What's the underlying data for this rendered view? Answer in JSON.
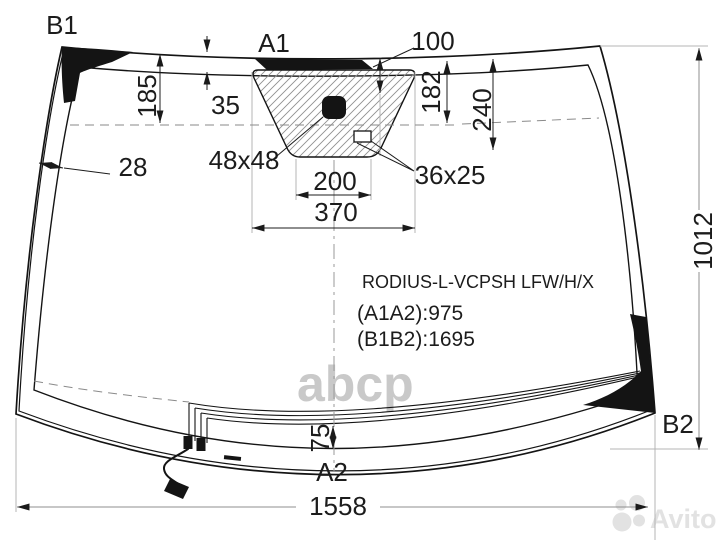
{
  "diagram": {
    "part_code": "RODIUS-L-VCPSH LFW/H/X",
    "diagonals": {
      "a1a2": "(A1A2):975",
      "b1b2": "(B1B2):1695"
    },
    "markers": {
      "b1": "B1",
      "a1": "A1",
      "a2": "A2",
      "b2": "B2"
    },
    "dims": {
      "d185": "185",
      "d35": "35",
      "d100": "100",
      "d182": "182",
      "d240": "240",
      "d28": "28",
      "d48": "48x48",
      "d36": "36x25",
      "d200": "200",
      "d370": "370",
      "d1012": "1012",
      "d75": "75",
      "d1558": "1558"
    }
  },
  "watermarks": {
    "center": "abcp",
    "brand": "Avito"
  },
  "colors": {
    "line": "#141414",
    "dimension_text": "#1c1c1c",
    "hatch": "#909090",
    "extension_line": "#b4b4b4",
    "watermark_center": "#c9c9c9",
    "watermark_brand": "#e2e2e2",
    "background": "#ffffff"
  }
}
